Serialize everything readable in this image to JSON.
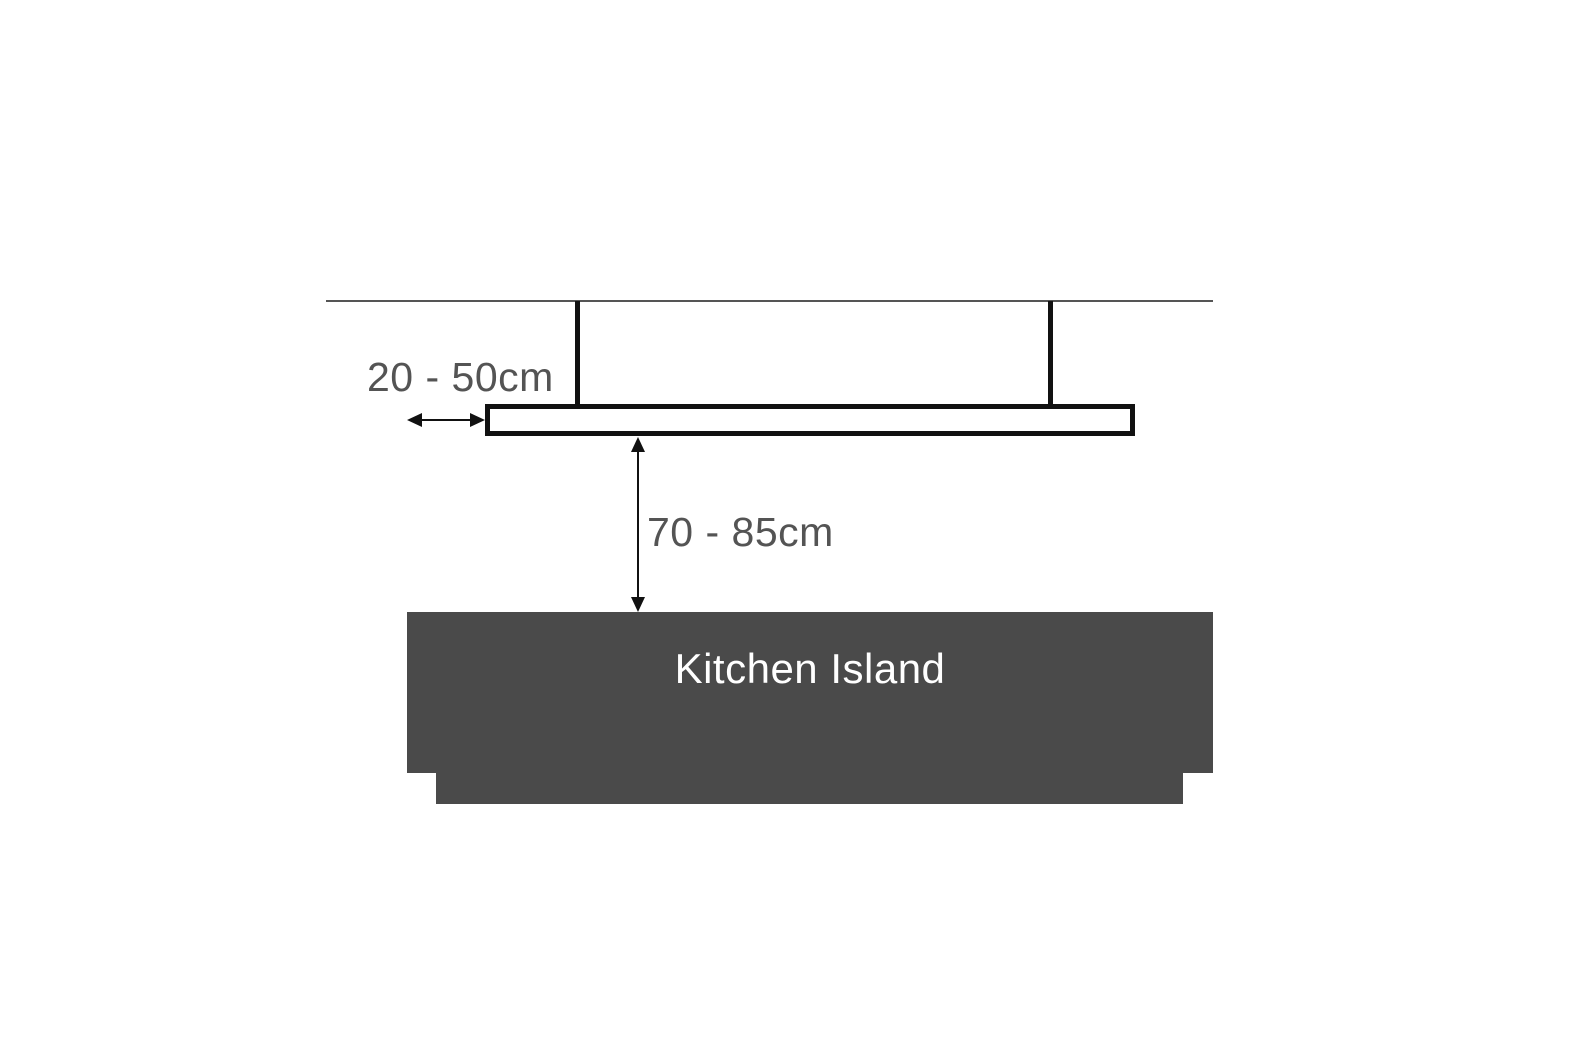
{
  "diagram": {
    "description": "Pendant light mounting-height diagram over a kitchen island",
    "labels": {
      "hanging_distance": "20 - 50cm",
      "drop_height": "70 - 85cm",
      "island": "Kitchen Island"
    },
    "colors": {
      "background": "#ffffff",
      "island": "#4a4a4a",
      "line": "#111111",
      "ceiling_line": "#555555",
      "label_text": "#545454",
      "island_text": "#ffffff"
    }
  }
}
